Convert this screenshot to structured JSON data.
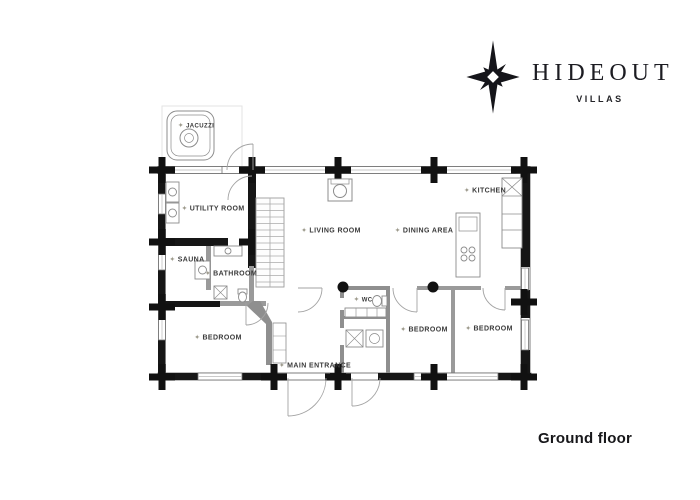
{
  "brand": {
    "name": "HIDEOUT",
    "tagline": "VILLAS"
  },
  "page": {
    "floor_label": "Ground floor"
  },
  "icons": {
    "label_star": "✦",
    "compass_star": "eight-point-compass-star"
  },
  "colors": {
    "wall_black": "#161616",
    "wall_gray": "#9a9a9a",
    "line_gray": "#8c8c8c",
    "label_text": "#3a3a3a",
    "background": "#ffffff"
  },
  "rooms": [
    {
      "name": "JACUZZI"
    },
    {
      "name": "UTILITY ROOM"
    },
    {
      "name": "SAUNA"
    },
    {
      "name": "BATHROOM"
    },
    {
      "name": "LIVING ROOM"
    },
    {
      "name": "DINING AREA"
    },
    {
      "name": "KITCHEN"
    },
    {
      "name": "WC"
    },
    {
      "name": "BEDROOM"
    },
    {
      "name": "BEDROOM"
    },
    {
      "name": "BEDROOM"
    },
    {
      "name": "MAIN ENTRANCE"
    }
  ]
}
